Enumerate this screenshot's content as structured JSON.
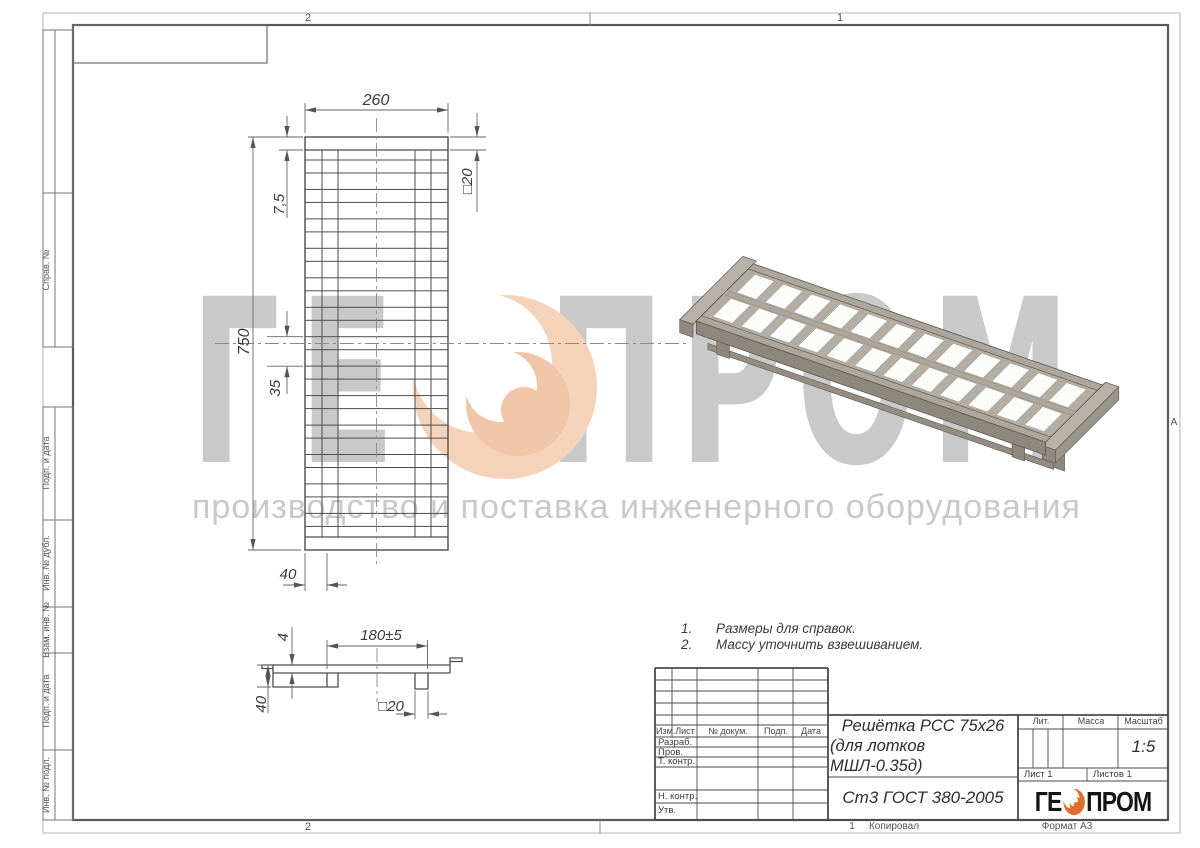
{
  "zones": {
    "top_left": "2",
    "top_right": "1",
    "bottom_left": "2",
    "bottom_right": "1",
    "row_marker": "А",
    "copy_label": "Копировал",
    "format_label": "Формат А3"
  },
  "margin_labels": {
    "items": [
      "Справ. №",
      "Подп. и дата",
      "Инв. № дубл.",
      "Взам. инв. №",
      "Подп. и дата",
      "Инв. № подл."
    ]
  },
  "dims": {
    "width": "260",
    "end_bar": "7,5",
    "tube_top": "□20",
    "length": "750",
    "pitch": "35",
    "side_offset": "40",
    "span": "180±5",
    "plate": "4",
    "height": "40",
    "tube_side": "□20"
  },
  "notes": {
    "n1": "1.",
    "t1": "Размеры для справок.",
    "n2": "2.",
    "t2": "Массу уточнить взвешиванием."
  },
  "title_block": {
    "cols": {
      "izm": "Изм.",
      "list": "Лист",
      "doc": "№ докум.",
      "podp": "Подп.",
      "date": "Дата"
    },
    "rows": {
      "razrab": "Разраб.",
      "prov": "Пров.",
      "tkontr": "Т. контр.",
      "nkontr": "Н. контр.",
      "utv": "Утв."
    },
    "name_line1": "Решётка РСС 75х26",
    "name_line2": "(для лотков МШЛ-0.35д)",
    "material": "Ст3 ГОСТ 380-2005",
    "lit": "Лит.",
    "massa": "Масса",
    "masshtab": "Масштаб",
    "scale": "1:5",
    "sheet_no": "Лист 1",
    "sheets_total": "Листов 1"
  },
  "logo": {
    "part1": "ГЕ",
    "part2": "ПРОМ"
  },
  "watermark": {
    "part1": "ГЕ",
    "part2": "ПРОМ",
    "subtitle": "производство и поставка инженерного оборудования"
  },
  "colors": {
    "accent_orange": "#e06f2b",
    "watermark_gray": "#c9c9c9",
    "watermark_peach": "#f5d3bb",
    "render_gray": "#b3ada4"
  }
}
